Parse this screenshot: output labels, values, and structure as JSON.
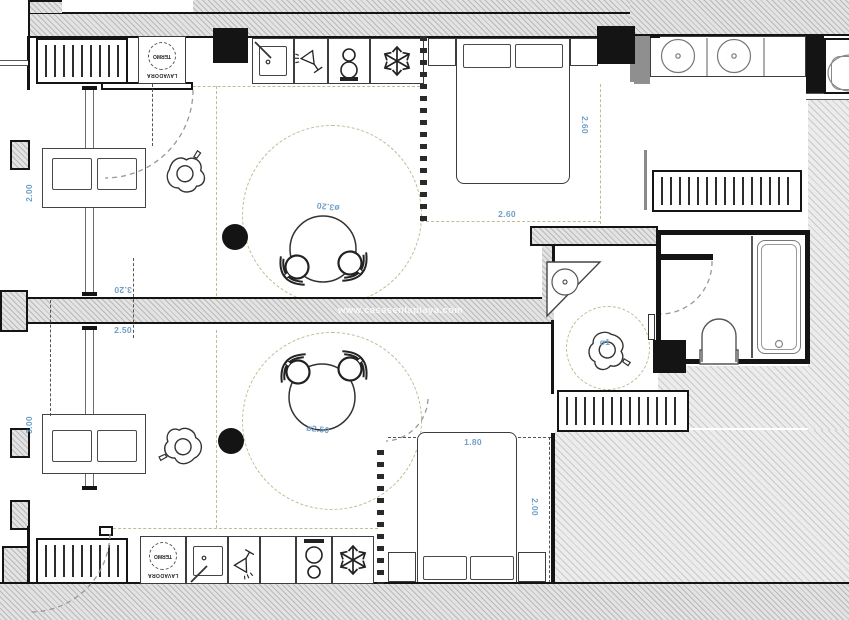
{
  "plan_title": "apartment-floor-plan",
  "watermark": "www.casasenlaplaya.com",
  "colors": {
    "dimension_text": "#6f9fc8",
    "wall": "#141414",
    "zone_dash": "#bdbd93",
    "hatch_line": "#c9c9c9"
  },
  "upper_unit": {
    "washer_label": "LAVADORA",
    "heater_label": "TERMO",
    "dim_living_height": "2.00",
    "dim_room_width": "3.20",
    "dim_bed_width": "2.60",
    "dim_bed_depth": "2.60",
    "dim_table_diameter": "ø3.20"
  },
  "lower_unit": {
    "washer_label": "LAVADORA",
    "heater_label": "TERMO",
    "dim_living_height": "3.00",
    "dim_room_width": "2.50",
    "dim_bed_width": "1.80",
    "dim_bed_depth": "2.00",
    "dim_table_diameter": "ø2.50"
  },
  "bathroom": {
    "dim_shower_circle": "ø1"
  },
  "icons": {
    "sink": "sink-icon",
    "wine_glass": "wine-glass-icon",
    "stove": "stove-icon",
    "snowflake": "snowflake-icon",
    "radiator": "radiator",
    "person": "person-figure"
  }
}
